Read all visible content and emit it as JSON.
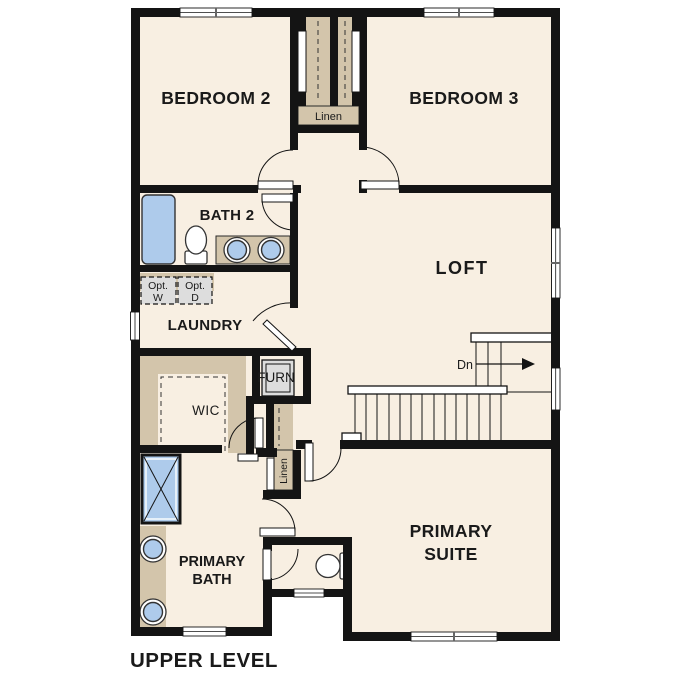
{
  "title": "UPPER LEVEL",
  "rooms": {
    "bedroom2": "BEDROOM 2",
    "bedroom3": "BEDROOM 3",
    "bath2": "BATH 2",
    "loft": "LOFT",
    "laundry": "LAUNDRY",
    "wic": "WIC",
    "furnace": "FURN",
    "primary_bath": {
      "line1": "PRIMARY",
      "line2": "BATH"
    },
    "primary_suite": {
      "line1": "PRIMARY",
      "line2": "SUITE"
    }
  },
  "closets": {
    "linen_top": "Linen",
    "linen_hall": "Linen"
  },
  "laundry_options": {
    "washer": {
      "line1": "Opt.",
      "line2": "W"
    },
    "dryer": {
      "line1": "Opt.",
      "line2": "D"
    }
  },
  "stairs": {
    "direction_label": "Dn"
  },
  "colors": {
    "background": "#FFFFFF",
    "floor": "#F8EFE2",
    "casework": "#D3C5AB",
    "fixture": "#AECBEB",
    "appliance": "#DDDDDD",
    "wall": "#141414",
    "text": "#1A1A1A"
  }
}
